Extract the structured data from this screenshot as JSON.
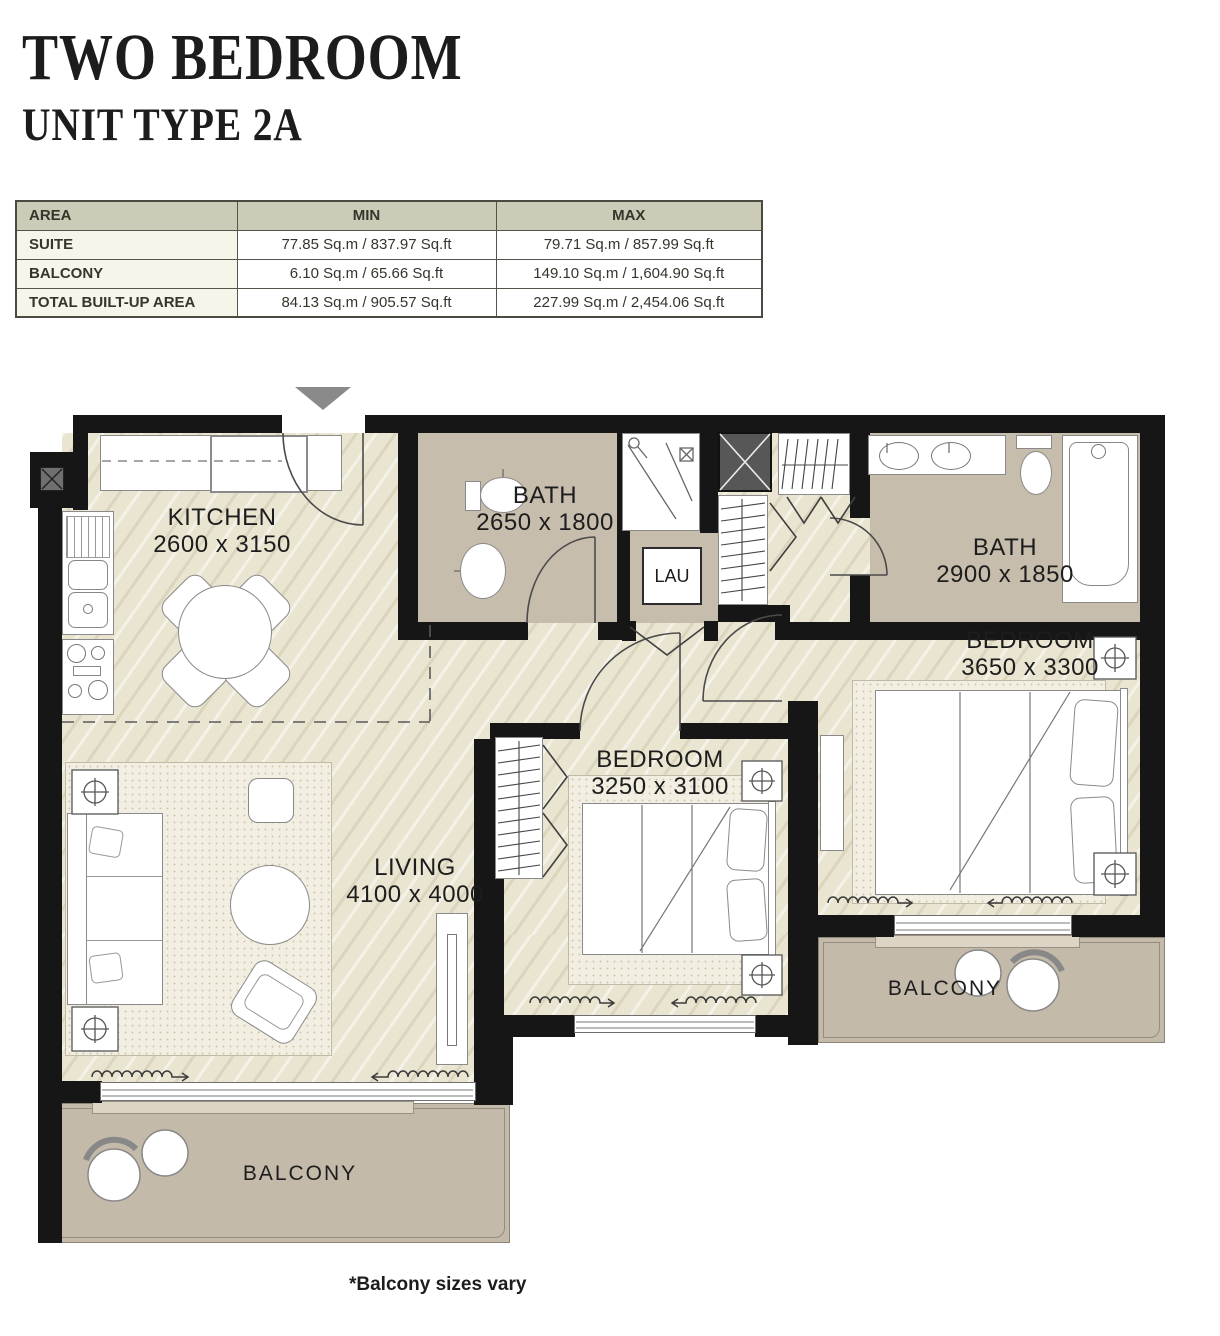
{
  "header": {
    "title": "TWO BEDROOM",
    "subtitle": "UNIT TYPE 2A"
  },
  "area_table": {
    "columns": [
      "AREA",
      "MIN",
      "MAX"
    ],
    "rows": [
      {
        "label": "SUITE",
        "min": "77.85 Sq.m / 837.97 Sq.ft",
        "max": "79.71 Sq.m / 857.99 Sq.ft"
      },
      {
        "label": "BALCONY",
        "min": "6.10 Sq.m / 65.66 Sq.ft",
        "max": "149.10 Sq.m / 1,604.90 Sq.ft"
      },
      {
        "label": "TOTAL BUILT-UP AREA",
        "min": "84.13 Sq.m / 905.57 Sq.ft",
        "max": "227.99 Sq.m / 2,454.06 Sq.ft"
      }
    ]
  },
  "floor_plan": {
    "rooms": {
      "kitchen": {
        "name": "KITCHEN",
        "dimensions": "2600 x 3150"
      },
      "bath1": {
        "name": "BATH",
        "dimensions": "2650 x 1800"
      },
      "bath2": {
        "name": "BATH",
        "dimensions": "2900 x 1850"
      },
      "bedroom_master": {
        "name": "BEDROOM",
        "dimensions": "3650 x 3300"
      },
      "bedroom2": {
        "name": "BEDROOM",
        "dimensions": "3250 x 3100"
      },
      "living": {
        "name": "LIVING",
        "dimensions": "4100 x 4000"
      },
      "laundry": {
        "name": "LAU"
      },
      "balcony_bottom": {
        "name": "BALCONY"
      },
      "balcony_right": {
        "name": "BALCONY"
      }
    },
    "note": "*Balcony sizes vary"
  },
  "colors": {
    "wall": "#161616",
    "floor": "#eae5d1",
    "bath_floor": "#c7bdad",
    "balcony_floor": "#c3baa9",
    "table_header_bg": "#cbcbb8",
    "table_label_bg": "#f6f5ea",
    "shaft_fill": "#575757",
    "entry_arrow": "#8a8a8a"
  }
}
